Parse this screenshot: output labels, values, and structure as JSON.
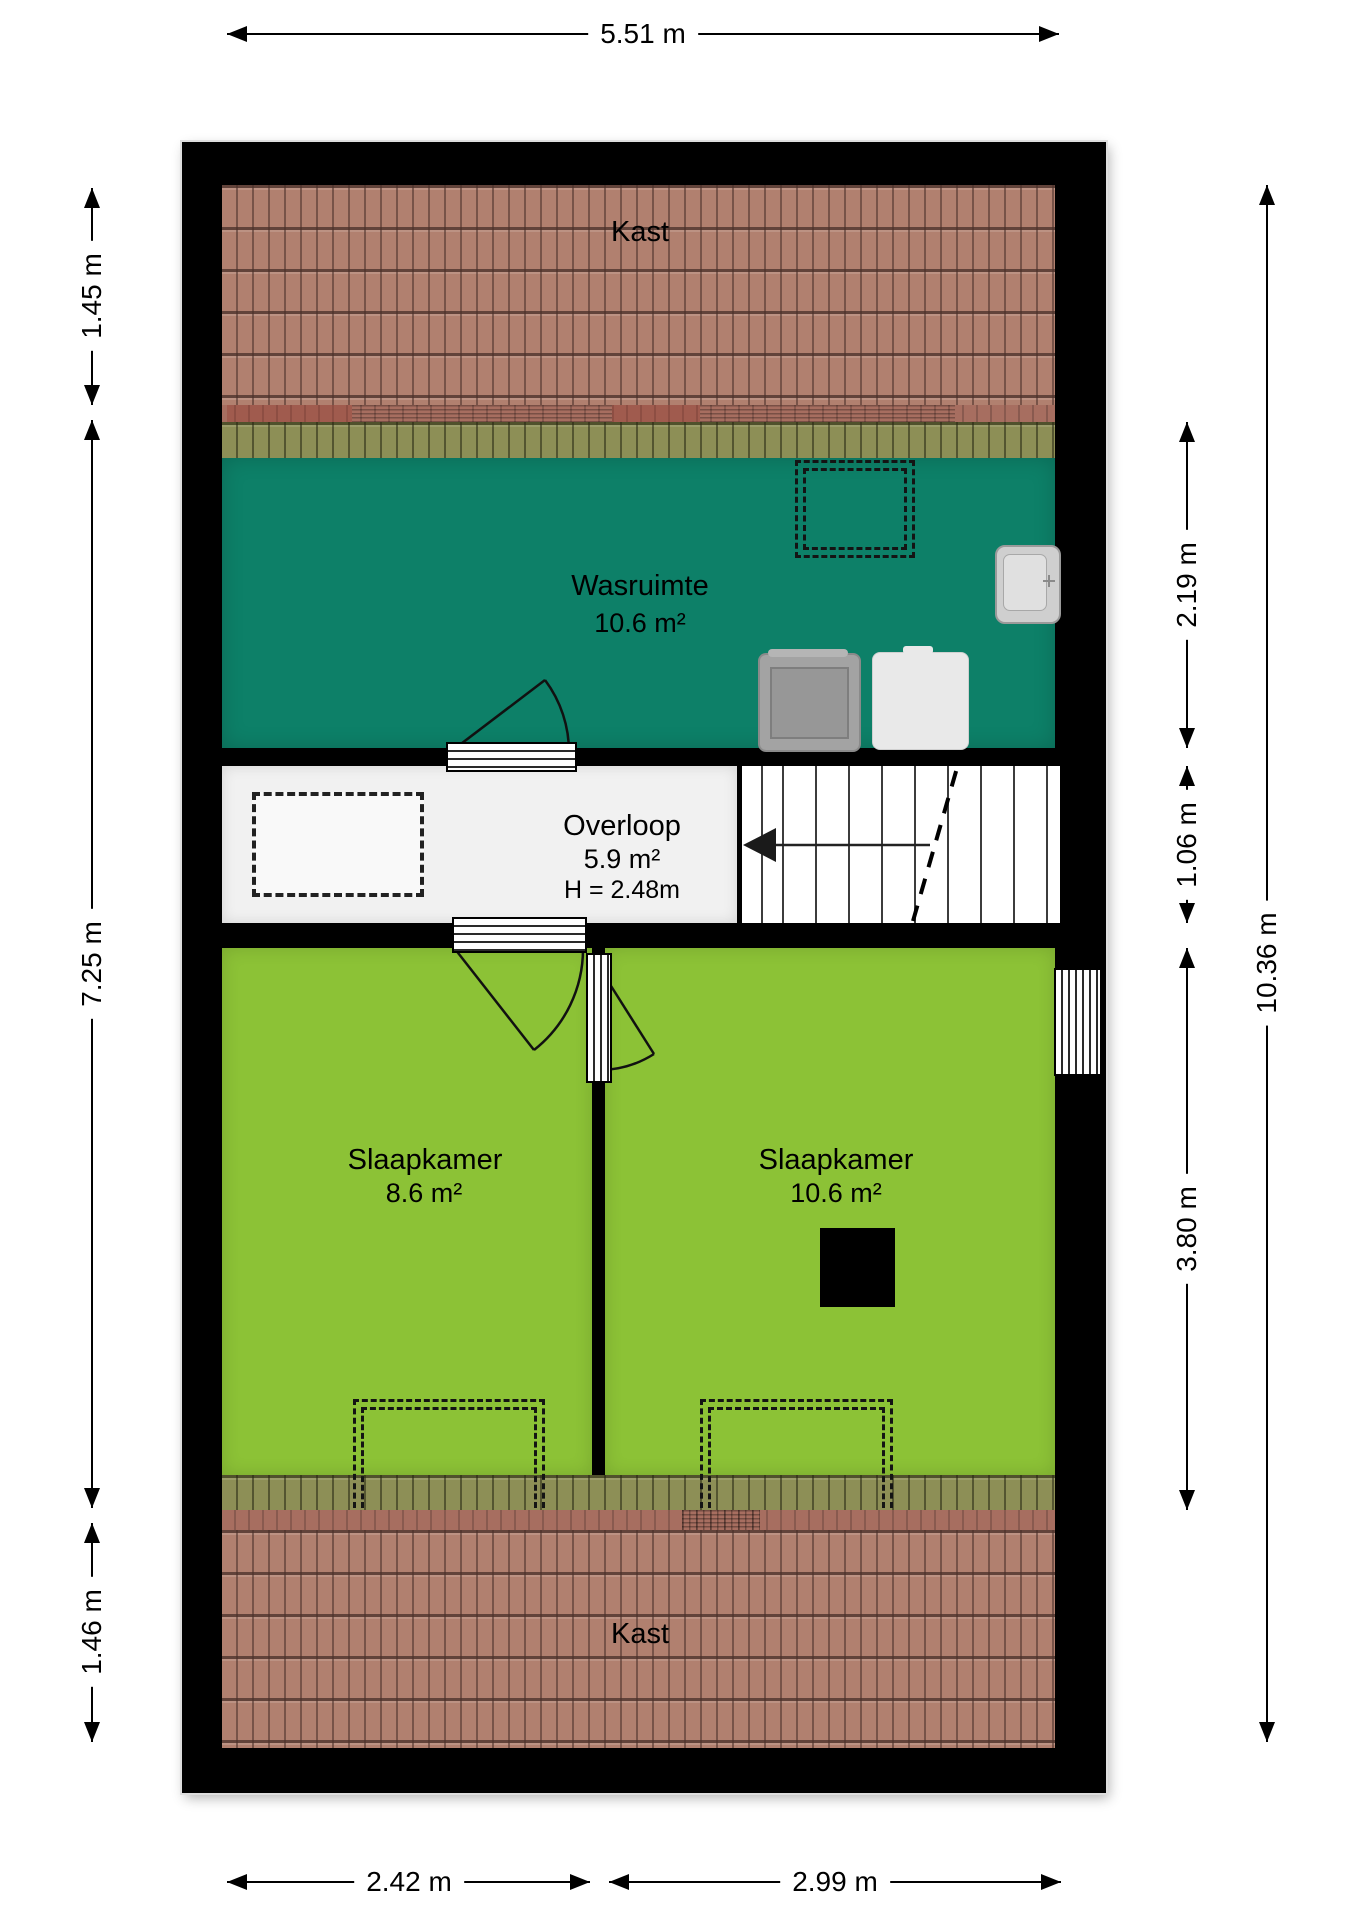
{
  "rooms": {
    "kast_top": {
      "name": "Kast"
    },
    "wasruimte": {
      "name": "Wasruimte",
      "area": "10.6 m²"
    },
    "overloop": {
      "name": "Overloop",
      "area": "5.9 m²",
      "ceiling_height": "H = 2.48m"
    },
    "slaapkamer_left": {
      "name": "Slaapkamer",
      "area": "8.6 m²"
    },
    "slaapkamer_right": {
      "name": "Slaapkamer",
      "area": "10.6 m²"
    },
    "kast_bottom": {
      "name": "Kast"
    }
  },
  "dimensions": {
    "top": {
      "label": "5.51 m"
    },
    "left": [
      {
        "label": "1.45 m"
      },
      {
        "label": "7.25 m"
      },
      {
        "label": "1.46 m"
      }
    ],
    "right": [
      {
        "label": "2.19 m"
      },
      {
        "label": "1.06 m"
      },
      {
        "label": "3.80 m"
      }
    ],
    "right_total": {
      "label": "10.36 m"
    },
    "bottom": [
      {
        "label": "2.42 m"
      },
      {
        "label": "2.99 m"
      }
    ]
  },
  "fixtures": {
    "wasruimte": [
      "skylight-dashed-outline",
      "sink",
      "washing-machine",
      "boiler"
    ],
    "overloop": [
      "reduced-headroom-dashed-outline",
      "staircase",
      "stairs-direction-arrow"
    ],
    "slaapkamer_left": [
      "dormer-dashed-outline",
      "door-swing"
    ],
    "slaapkamer_right": [
      "dormer-dashed-outline",
      "door-swing",
      "flue-block",
      "window"
    ],
    "doors": [
      "wasruimte-door",
      "slaapkamer-left-door",
      "slaapkamer-right-door"
    ]
  },
  "colors": {
    "wall": "#000000",
    "wasruimte_floor": "#0d8068",
    "slaapkamer_floor": "#8cc236",
    "overloop_floor": "#f1f1f1",
    "roof_tiles": "#b1806f",
    "roof_band_olive": "#8d8f56",
    "roof_strip_red": "#a76e60"
  }
}
